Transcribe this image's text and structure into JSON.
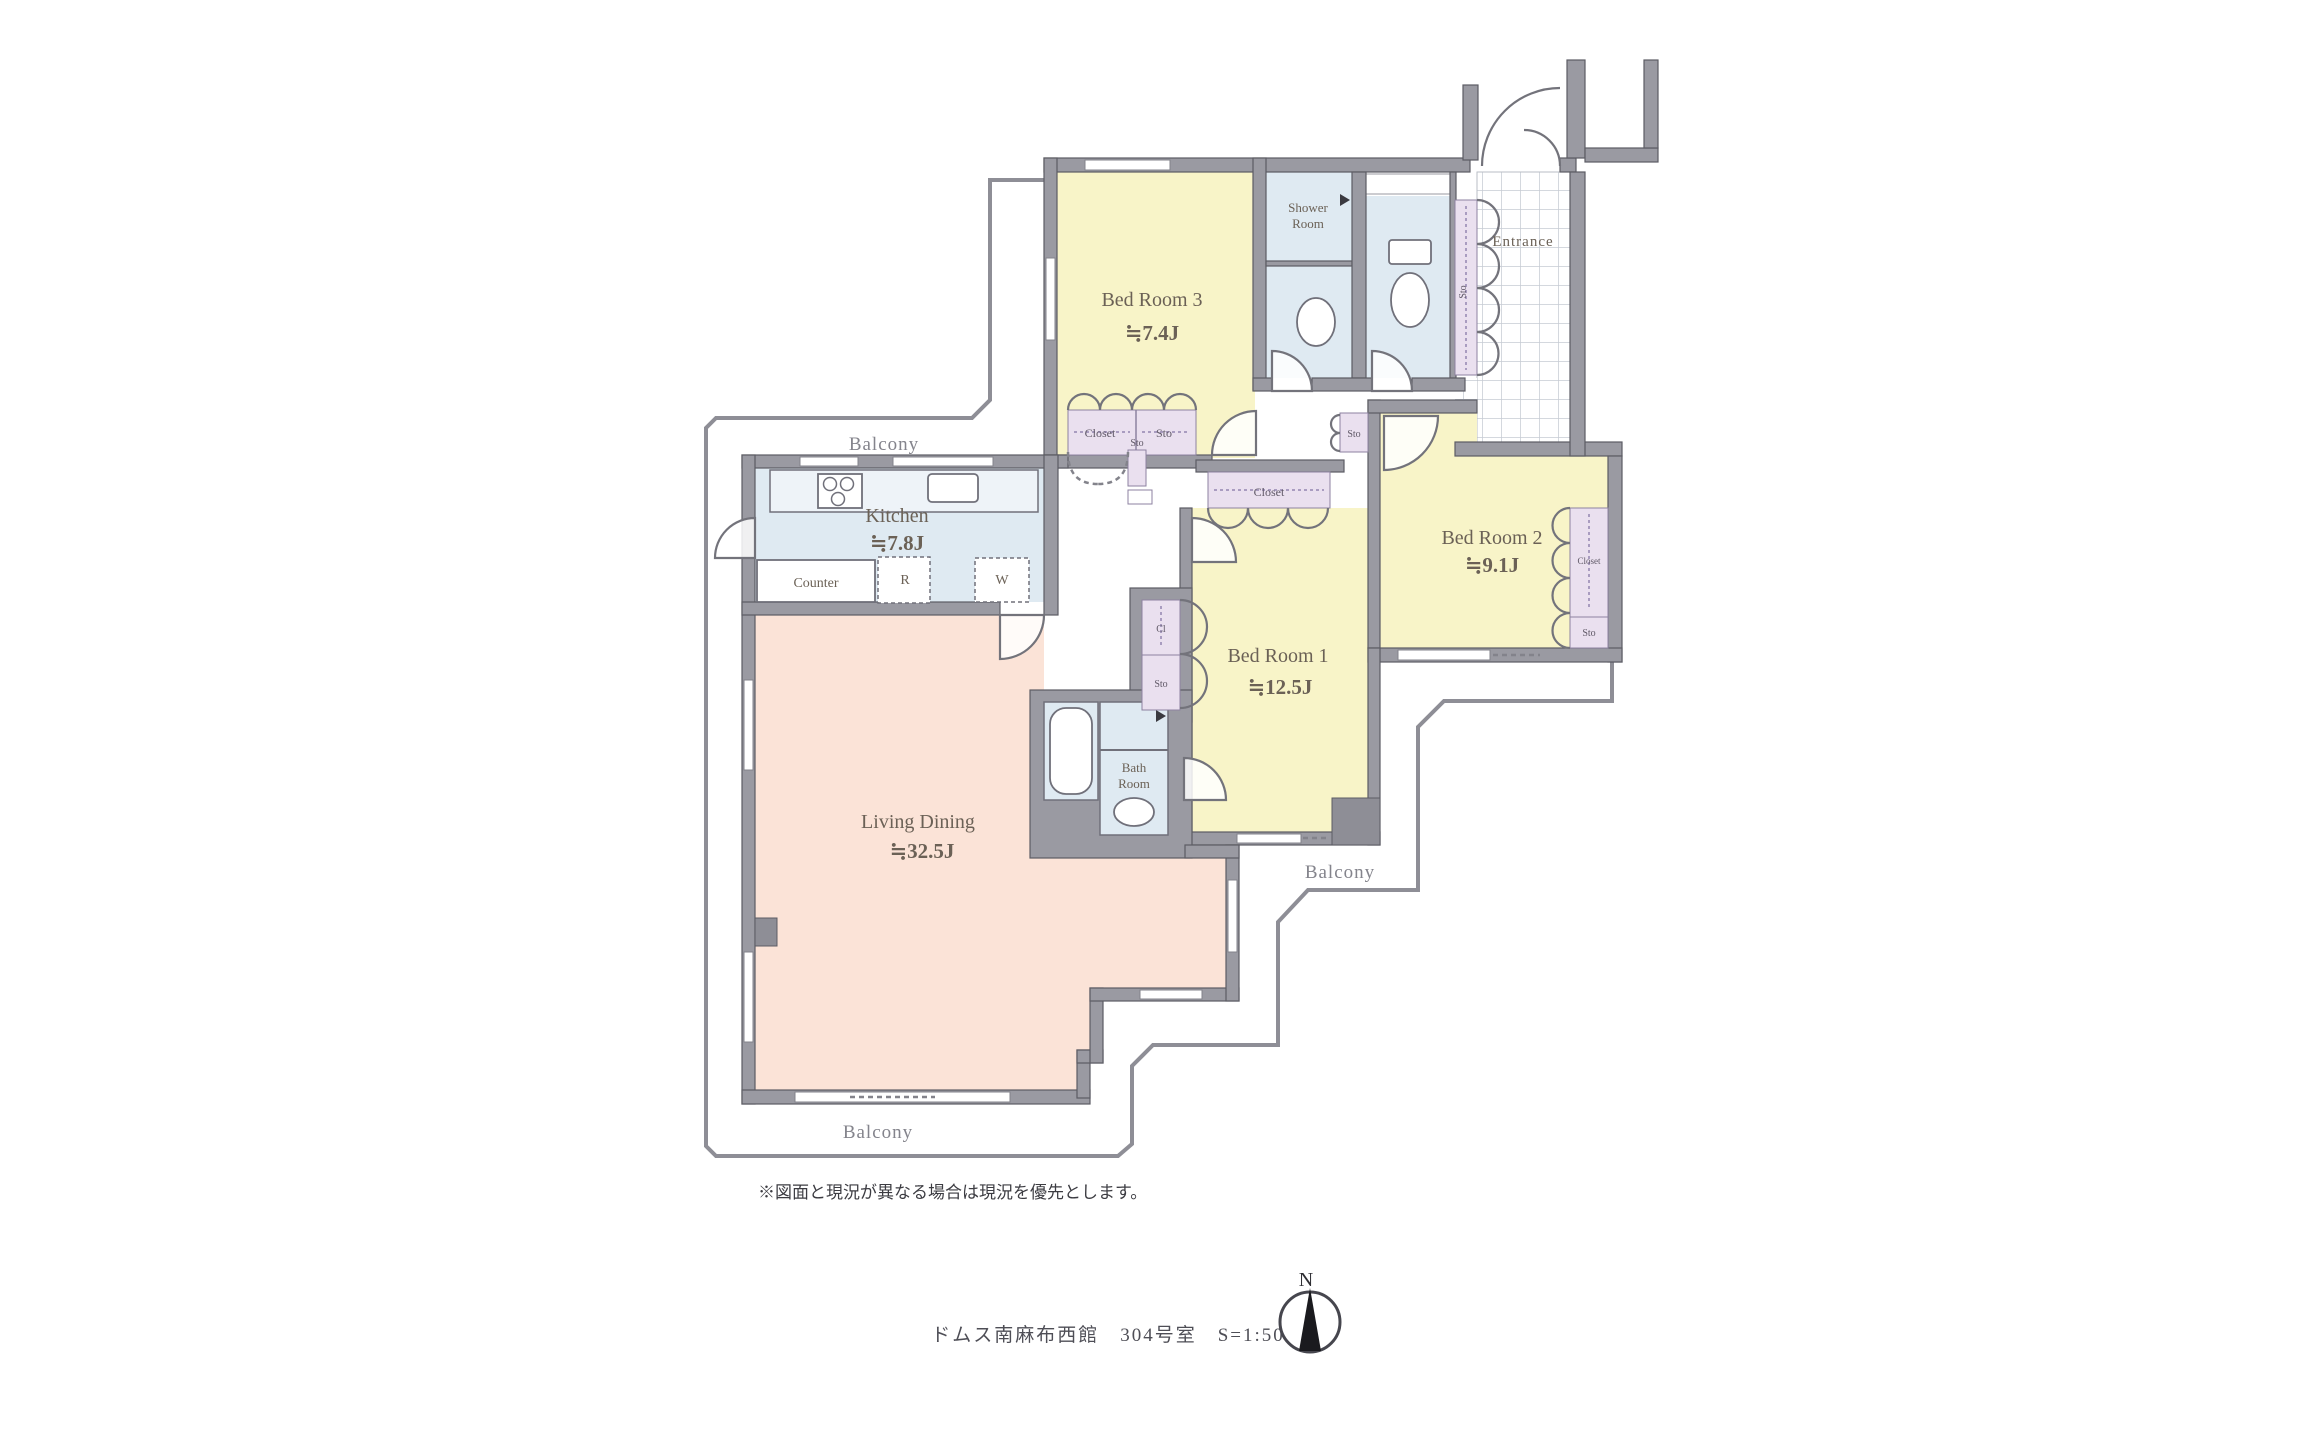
{
  "colors": {
    "room_yellow": "#f8f4c8",
    "wet_blue": "#dfeaf2",
    "living_peach": "#fbe3d7",
    "storage_lavender": "#eae0ef",
    "wall_gray": "#9a9aa2",
    "balcony_line": "#8e8e96",
    "label_brown": "#6b6156"
  },
  "plan": {
    "rooms": {
      "bed3": {
        "name": "Bed Room 3",
        "size": "≒7.4J"
      },
      "bed2": {
        "name": "Bed Room 2",
        "size": "≒9.1J"
      },
      "bed1": {
        "name": "Bed Room 1",
        "size": "≒12.5J"
      },
      "kitchen": {
        "name": "Kitchen",
        "size": "≒7.8J"
      },
      "living": {
        "name": "Living Dining",
        "size": "≒32.5J"
      },
      "shower": {
        "line1": "Shower",
        "line2": "Room"
      },
      "bath": {
        "line1": "Bath",
        "line2": "Room"
      },
      "entrance": {
        "name": "Entrance"
      }
    },
    "fixtures": {
      "counter": "Counter",
      "refrigerator": "R",
      "washer": "W"
    },
    "storage": {
      "closet": "Closet",
      "sto": "Sto",
      "cl": "Cl"
    },
    "balcony_label": "Balcony",
    "compass": {
      "north": "N"
    },
    "footer": {
      "note": "※図面と現況が異なる場合は現況を優先とします。",
      "caption": "ドムス南麻布西館　304号室　S=1:50"
    }
  }
}
